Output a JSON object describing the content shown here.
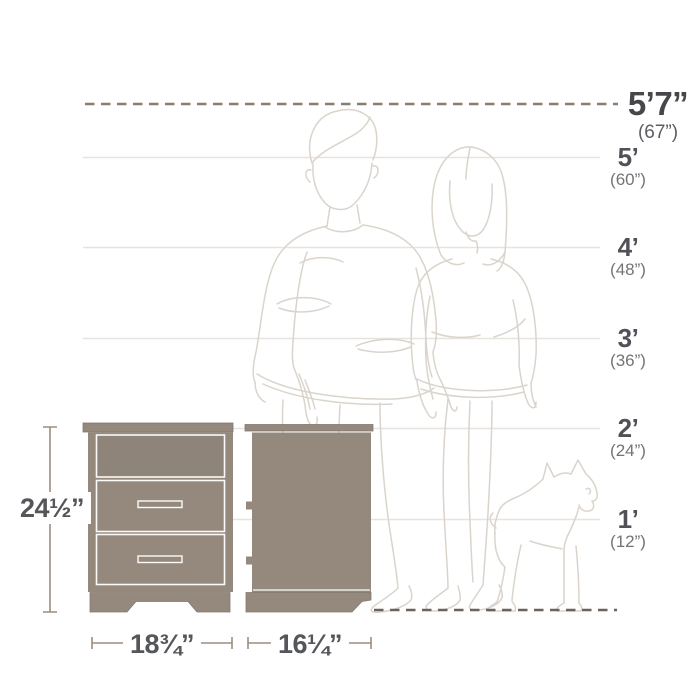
{
  "scale": {
    "labels": [
      {
        "feet": "5’7”",
        "inches": "(67”)"
      },
      {
        "feet": "5’",
        "inches": "(60”)"
      },
      {
        "feet": "4’",
        "inches": "(48”)"
      },
      {
        "feet": "3’",
        "inches": "(36”)"
      },
      {
        "feet": "2’",
        "inches": "(24”)"
      },
      {
        "feet": "1’",
        "inches": "(12”)"
      }
    ]
  },
  "product": {
    "height": "24½”",
    "width": "18¾”",
    "depth": "16¼”"
  },
  "colors": {
    "furniture_fill": "#95897e",
    "furniture_edge": "#84796e",
    "separator": "#fbfaf8",
    "top_dash": "#8a7c6f",
    "floor_dash": "#6e635a",
    "gridline": "#e7e4e0",
    "dimension_line": "#9b8d80",
    "figure_line": "#dad4cc"
  }
}
